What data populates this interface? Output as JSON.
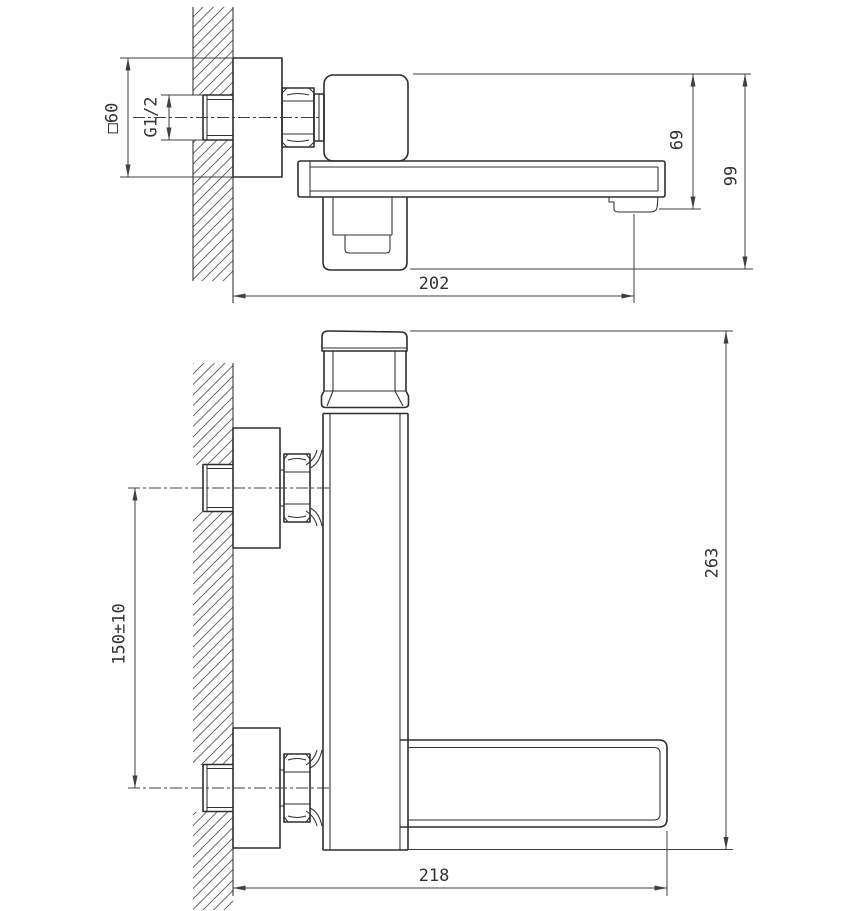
{
  "drawing": {
    "colors": {
      "line": "#2e2e2e",
      "dimension": "#3f3f3f",
      "text": "#333333",
      "background": "#ffffff"
    },
    "views": {
      "side": {
        "labels": {
          "flange": "□60",
          "thread": "G1/2",
          "spout_drop": "69",
          "overall_drop": "99",
          "reach": "202"
        }
      },
      "front": {
        "labels": {
          "inlet_spacing": "150±10",
          "overall_height": "263",
          "reach": "218"
        }
      }
    }
  }
}
